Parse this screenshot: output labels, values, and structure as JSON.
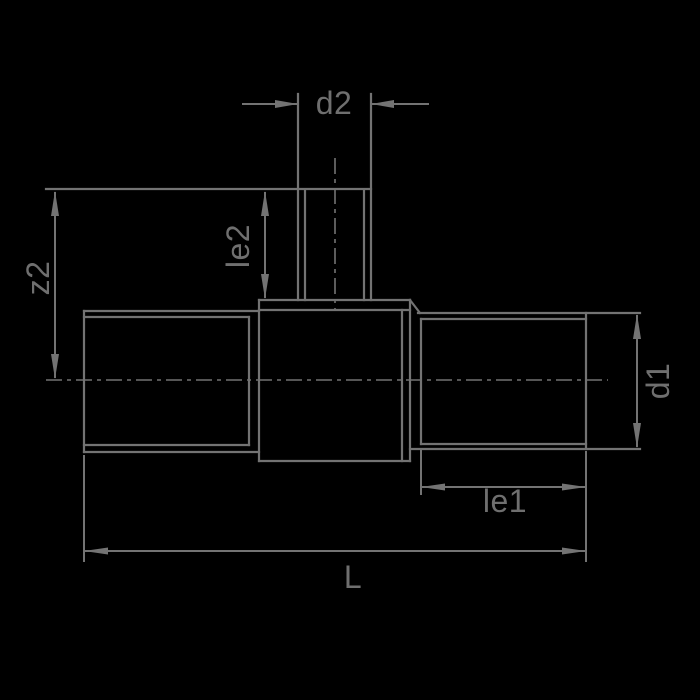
{
  "drawing": {
    "background_color": "#000000",
    "line_color": "#737373",
    "text_color": "#6f6f6f",
    "labels": {
      "d2": "d2",
      "le2": "le2",
      "z2": "z2",
      "d1": "d1",
      "le1": "le1",
      "L": "L"
    }
  }
}
